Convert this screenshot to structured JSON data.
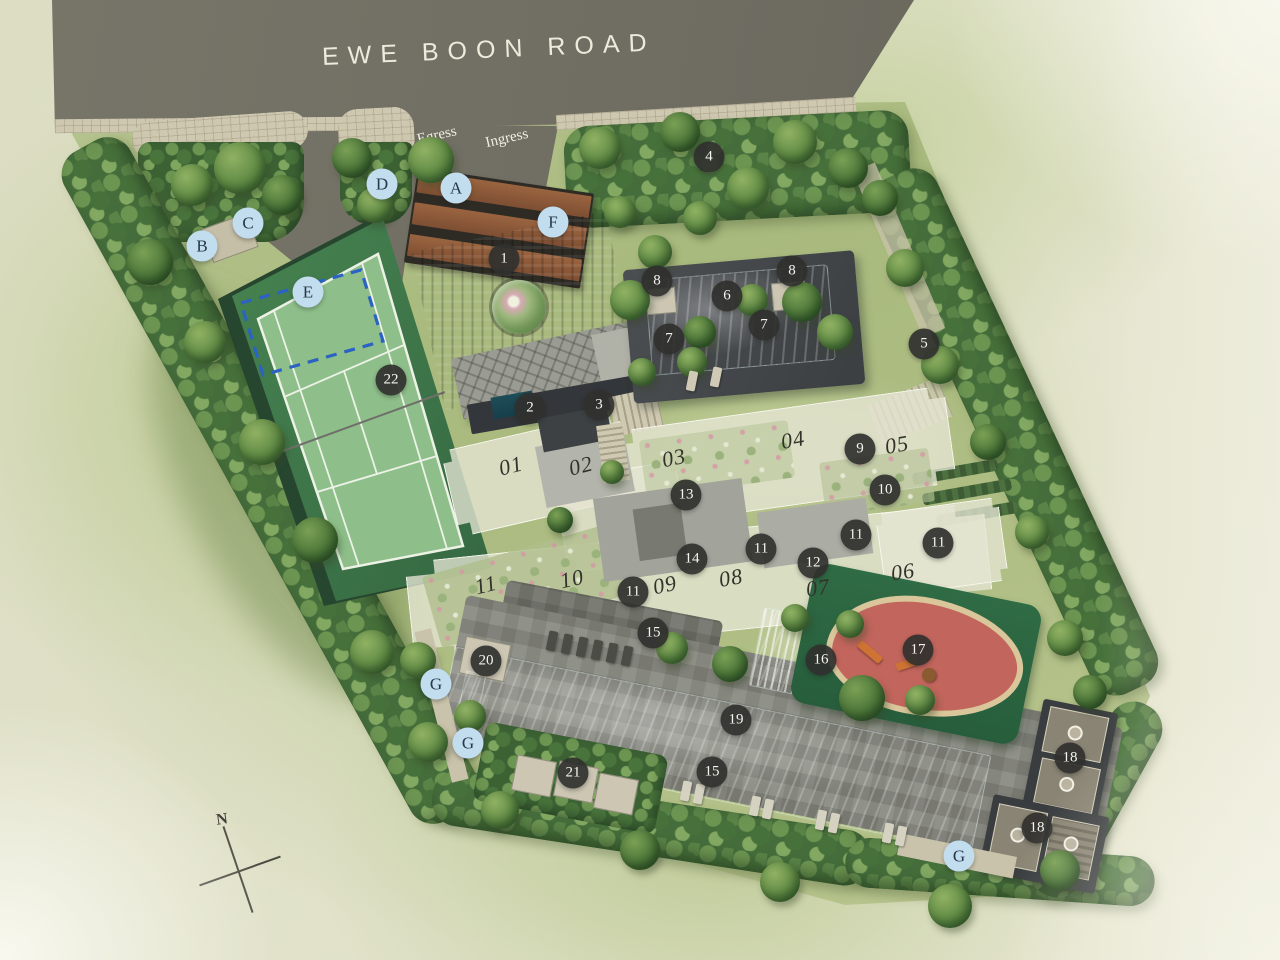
{
  "plan": {
    "road_name": "EWE BOON ROAD",
    "egress_label": "Egress",
    "ingress_label": "Ingress",
    "compass_label": "N",
    "colors": {
      "road": "#6e6c61",
      "lawn": "#afbe84",
      "water": "#2fb4c9",
      "tennis_court": "#41794b",
      "marker_dark": "#303030",
      "marker_light": "#c2ddee",
      "dashed_outline": "#2b62c4",
      "playground_red": "#c2655c"
    },
    "letter_markers": [
      {
        "label": "A",
        "x": 456,
        "y": 188
      },
      {
        "label": "B",
        "x": 202,
        "y": 246
      },
      {
        "label": "C",
        "x": 248,
        "y": 223
      },
      {
        "label": "D",
        "x": 382,
        "y": 184
      },
      {
        "label": "E",
        "x": 308,
        "y": 292
      },
      {
        "label": "F",
        "x": 553,
        "y": 222
      },
      {
        "label": "G",
        "x": 436,
        "y": 684
      },
      {
        "label": "G",
        "x": 468,
        "y": 743
      },
      {
        "label": "G",
        "x": 959,
        "y": 856
      }
    ],
    "number_markers": [
      {
        "label": "1",
        "x": 504,
        "y": 259
      },
      {
        "label": "2",
        "x": 530,
        "y": 408
      },
      {
        "label": "3",
        "x": 599,
        "y": 405
      },
      {
        "label": "4",
        "x": 709,
        "y": 157
      },
      {
        "label": "5",
        "x": 924,
        "y": 344
      },
      {
        "label": "6",
        "x": 727,
        "y": 296
      },
      {
        "label": "7",
        "x": 669,
        "y": 339
      },
      {
        "label": "7",
        "x": 764,
        "y": 325
      },
      {
        "label": "8",
        "x": 657,
        "y": 281
      },
      {
        "label": "8",
        "x": 792,
        "y": 271
      },
      {
        "label": "9",
        "x": 860,
        "y": 449
      },
      {
        "label": "10",
        "x": 885,
        "y": 490
      },
      {
        "label": "11",
        "x": 633,
        "y": 592
      },
      {
        "label": "11",
        "x": 761,
        "y": 549
      },
      {
        "label": "11",
        "x": 856,
        "y": 535
      },
      {
        "label": "11",
        "x": 938,
        "y": 543
      },
      {
        "label": "12",
        "x": 813,
        "y": 563
      },
      {
        "label": "13",
        "x": 686,
        "y": 495
      },
      {
        "label": "14",
        "x": 692,
        "y": 559
      },
      {
        "label": "15",
        "x": 653,
        "y": 633
      },
      {
        "label": "15",
        "x": 712,
        "y": 772
      },
      {
        "label": "16",
        "x": 821,
        "y": 660
      },
      {
        "label": "17",
        "x": 918,
        "y": 650
      },
      {
        "label": "18",
        "x": 1070,
        "y": 758
      },
      {
        "label": "18",
        "x": 1037,
        "y": 828
      },
      {
        "label": "19",
        "x": 736,
        "y": 720
      },
      {
        "label": "20",
        "x": 486,
        "y": 661
      },
      {
        "label": "21",
        "x": 573,
        "y": 773
      },
      {
        "label": "22",
        "x": 391,
        "y": 380
      }
    ],
    "unit_labels": [
      {
        "label": "01",
        "x": 511,
        "y": 466,
        "rot": -14
      },
      {
        "label": "02",
        "x": 581,
        "y": 466,
        "rot": -14
      },
      {
        "label": "03",
        "x": 674,
        "y": 458,
        "rot": -12
      },
      {
        "label": "04",
        "x": 793,
        "y": 440,
        "rot": -10
      },
      {
        "label": "05",
        "x": 897,
        "y": 445,
        "rot": -10
      },
      {
        "label": "06",
        "x": 903,
        "y": 572,
        "rot": -8
      },
      {
        "label": "07",
        "x": 818,
        "y": 588,
        "rot": -8
      },
      {
        "label": "08",
        "x": 731,
        "y": 578,
        "rot": -10
      },
      {
        "label": "09",
        "x": 665,
        "y": 585,
        "rot": -12
      },
      {
        "label": "10",
        "x": 572,
        "y": 579,
        "rot": -12
      },
      {
        "label": "11",
        "x": 486,
        "y": 585,
        "rot": -14
      }
    ]
  }
}
